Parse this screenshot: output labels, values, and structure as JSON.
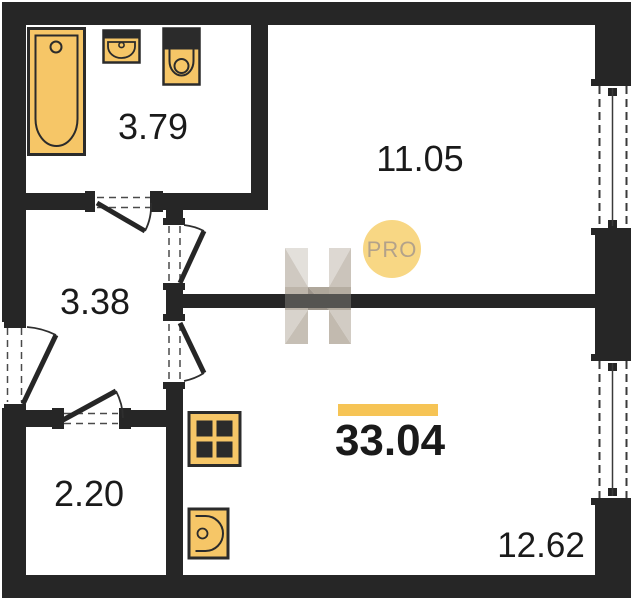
{
  "plan": {
    "title": "apartment-floor-plan",
    "total": {
      "area": "33.04"
    },
    "rooms": {
      "bathroom": {
        "area": "3.79"
      },
      "living": {
        "area": "11.05"
      },
      "hallway": {
        "area": "3.38"
      },
      "storage": {
        "area": "2.20"
      },
      "kitchen_living": {
        "area": "12.62"
      }
    },
    "badge": {
      "label": "PRO"
    },
    "watermark": {
      "logo_letter": "H"
    },
    "fixtures": {
      "bathtub": "bathtub",
      "washbasin": "washbasin",
      "toilet": "toilet",
      "stove": "stove-4-burner",
      "kitchen_sink": "kitchen-sink"
    },
    "colors": {
      "wall": "#262626",
      "fixture": "#F6C667",
      "fixture_dark": "#2B2B2B",
      "accent_bar": "#F6C455",
      "badge_fill": "#F8D784",
      "badge_text": "#B3A28A",
      "label_text": "#1A1A1A"
    }
  }
}
